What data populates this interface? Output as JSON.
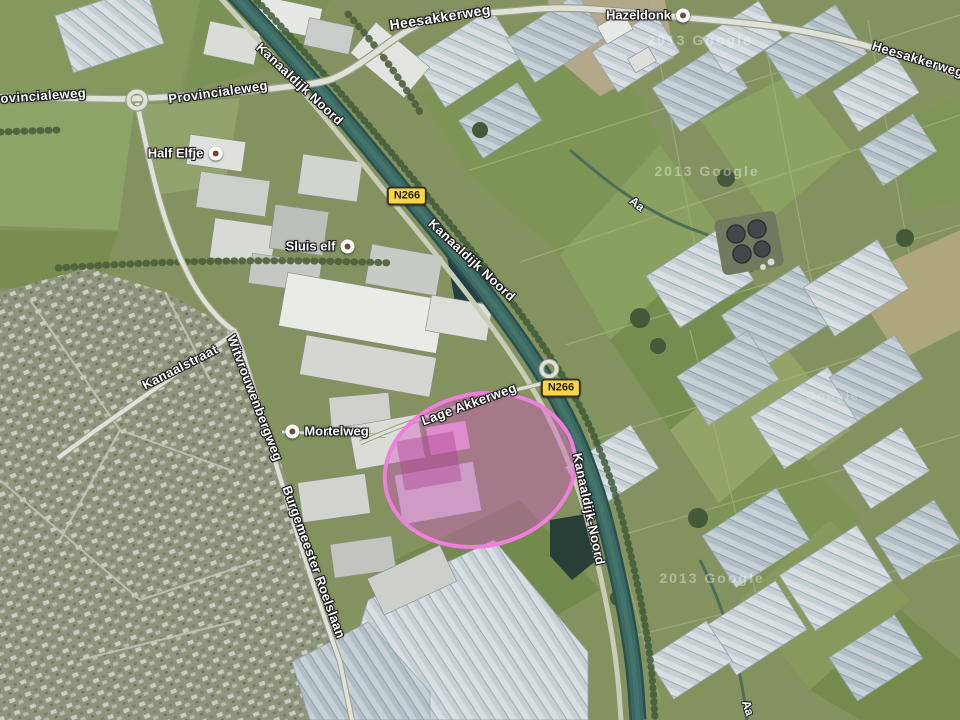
{
  "map": {
    "type": "satellite-map",
    "road_labels": [
      {
        "text": "Heesakkerweg"
      },
      {
        "text": "Heesakkerweg"
      },
      {
        "text": "Provincialeweg"
      },
      {
        "text": "Provincialeweg"
      },
      {
        "text": "Kanaaldijk Noord"
      },
      {
        "text": "Kanaaldijk Noord"
      },
      {
        "text": "Kanaaldijk-Noord"
      },
      {
        "text": "Kanaalstraat"
      },
      {
        "text": "Witvrouwenbergweg"
      },
      {
        "text": "Burgemeester Roelslaan"
      },
      {
        "text": "Lage Akkerweg"
      }
    ],
    "poi_labels": [
      {
        "name": "Half Elfje"
      },
      {
        "name": "Sluis elf"
      },
      {
        "name": "Hazeldonk"
      },
      {
        "name": "Mortelweg"
      }
    ],
    "route_badges": [
      {
        "label": "N266"
      },
      {
        "label": "N266"
      }
    ],
    "water_labels": [
      {
        "text": "Aa"
      },
      {
        "text": "Aa"
      }
    ],
    "watermarks": [
      {
        "text": "2013 Google"
      },
      {
        "text": "2013 Google"
      },
      {
        "text": "2013 Google"
      },
      {
        "text": "Google"
      }
    ],
    "highlight": {
      "shape": "ellipse",
      "stroke_color": "#ee7fdc",
      "fill_color": "#d457c4"
    },
    "colors": {
      "badge_yellow": "#fbd643",
      "canal_water": "#35635f",
      "field_green": "#83925f"
    }
  }
}
